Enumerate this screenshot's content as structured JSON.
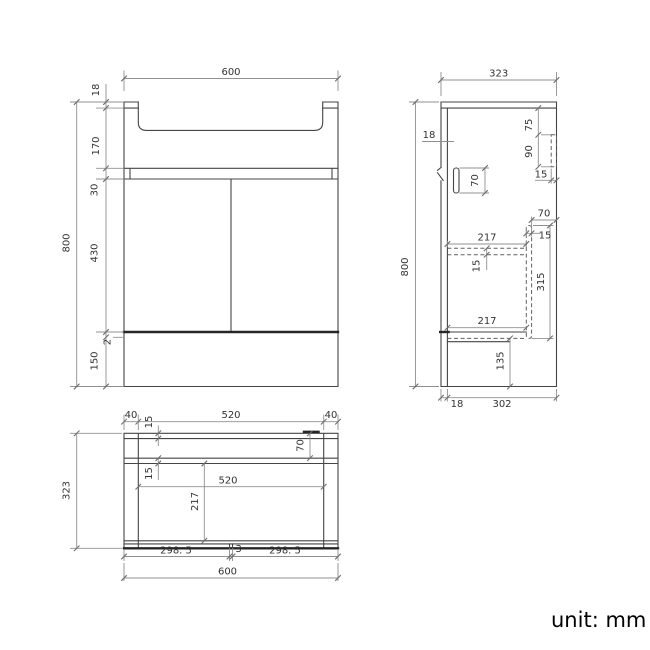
{
  "footer": {
    "unit_label": "unit: mm"
  },
  "front_view": {
    "width": "600",
    "height": "800",
    "top_thickness": "18",
    "basin_height": "170",
    "rail_height": "30",
    "door_height": "430",
    "gap": "2",
    "base_height": "150"
  },
  "side_view": {
    "depth": "323",
    "height": "800",
    "door_thickness": "18",
    "bracket_offset": "75",
    "bracket_height": "90",
    "bracket_width": "15",
    "pill_height": "70",
    "panel_gap": "70",
    "panel_thickness": "15",
    "shelf_depth_top": "217",
    "shelf_thickness": "15",
    "panel_height": "315",
    "shelf_depth_bottom": "217",
    "base_height": "135",
    "bottom_door": "18",
    "bottom_depth": "302"
  },
  "plan_view": {
    "margin_left": "40",
    "basin_width": "520",
    "margin_right": "40",
    "back_thickness": "15",
    "rail_offset": "70",
    "rail_thickness": "15",
    "inner_width": "520",
    "inner_depth": "217",
    "depth": "323",
    "door_left": "298. 5",
    "door_gap": "3",
    "door_right": "298. 5",
    "width": "600"
  }
}
